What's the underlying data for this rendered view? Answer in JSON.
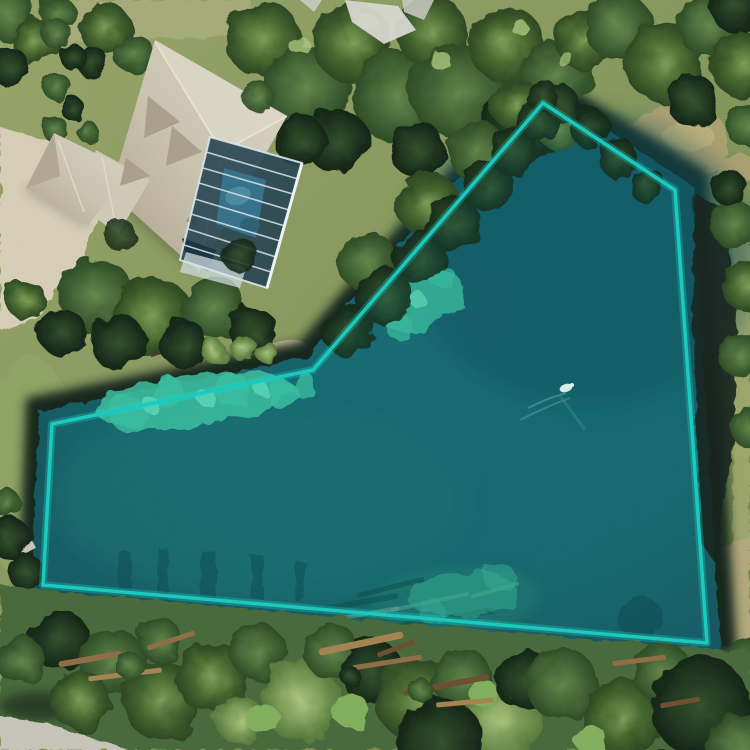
{
  "meta": {
    "view": "aerial-satellite-map",
    "canvas_width": 750,
    "canvas_height": 750,
    "visible_text": "none"
  },
  "annotation": {
    "shape": "polygon",
    "highlighted_feature": "pond",
    "vertex_count": 6,
    "vertices": [
      [
        543,
        103
      ],
      [
        675,
        190
      ],
      [
        707,
        643
      ],
      [
        43,
        585
      ],
      [
        52,
        424
      ],
      [
        313,
        370
      ]
    ],
    "svg_points": "543,103 675,190 707,643 43,585 52,424 313,370",
    "stroke_color": "#1cc9bd",
    "fill_color": "rgba(30,205,192,0.07)",
    "stroke_width": 3.5
  },
  "scene": {
    "imagery": "satellite-photo",
    "features": {
      "pond": {
        "description": "dark teal pond filling the polygon",
        "color": "#175e66"
      },
      "algae_patches": {
        "color": "#3dbd9c"
      },
      "house": {
        "description": "large hip-roof house at top-left",
        "roof_color": "#c8c1ae"
      },
      "pool_enclosure": {
        "description": "screened pool cage beside house",
        "frame_color": "#d9e6ea",
        "water_color": "#4a89a0"
      },
      "driveway": {
        "color": "#d6cdb6"
      },
      "road": {
        "description": "street corner at bottom-left",
        "color": "#c6c3b8"
      },
      "bird_on_water": {
        "color": "#e6ecec"
      },
      "shore_structure": {
        "color": "#4c3c28"
      },
      "dock": {
        "color": "#d2d4cd"
      },
      "tree_canopy": {
        "colors": [
          "#2d4b26",
          "#46672f",
          "#a8c47a"
        ]
      },
      "grass": {
        "color": "#83955a"
      },
      "shore_sand": {
        "color": "#b6a97e"
      }
    }
  }
}
